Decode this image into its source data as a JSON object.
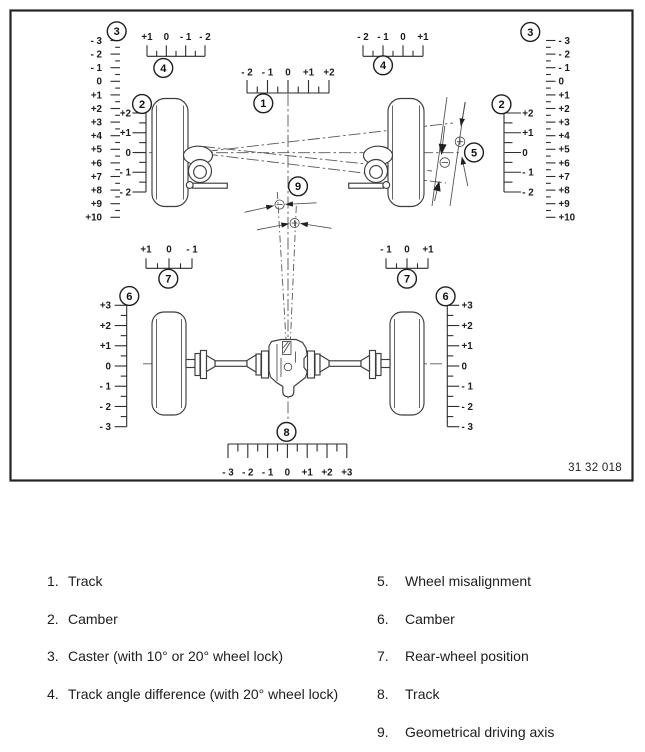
{
  "figure": {
    "drawing_number": "31 32 018"
  },
  "markers": {
    "track_front": "1",
    "camber_front": "2",
    "caster": "3",
    "track_angle": "4",
    "wheel_misalignment": "5",
    "camber_rear": "6",
    "rear_wheel_position": "7",
    "track_rear": "8",
    "geometrical_driving_axis": "9"
  },
  "scales": {
    "caster": [
      "- 3",
      "- 2",
      "- 1",
      "0",
      "+1",
      "+2",
      "+3",
      "+4",
      "+5",
      "+6",
      "+7",
      "+8",
      "+9",
      "+10"
    ],
    "track_angle_left": [
      "+1",
      "0",
      "- 1",
      "- 2"
    ],
    "track_angle_right": [
      "- 2",
      "- 1",
      "0",
      "+1"
    ],
    "track_front": [
      "- 2",
      "- 1",
      "0",
      "+1",
      "+2"
    ],
    "camber_front": [
      "+2",
      "+1",
      "0",
      "- 1",
      "- 2"
    ],
    "rear_pos_left": [
      "+1",
      "0",
      "- 1"
    ],
    "rear_pos_right": [
      "- 1",
      "0",
      "+1"
    ],
    "camber_rear": [
      "+3",
      "+2",
      "+1",
      "0",
      "- 1",
      "- 2",
      "- 3"
    ],
    "track_rear": [
      "- 3",
      "- 2",
      "- 1",
      "0",
      "+1",
      "+2",
      "+3"
    ]
  },
  "signs": {
    "plus": "+",
    "minus": "−"
  },
  "legend": {
    "left": [
      {
        "num": "1.",
        "key": "track-front",
        "label": "Track"
      },
      {
        "num": "2.",
        "key": "camber-front",
        "label": "Camber"
      },
      {
        "num": "3.",
        "key": "caster",
        "label": "Caster (with 10° or 20° wheel lock)"
      },
      {
        "num": "4.",
        "key": "track-angle-difference",
        "label": "Track angle difference (with 20° wheel lock)"
      }
    ],
    "right": [
      {
        "num": "5.",
        "key": "wheel-misalignment",
        "label": "Wheel misalignment"
      },
      {
        "num": "6.",
        "key": "camber-rear",
        "label": "Camber"
      },
      {
        "num": "7.",
        "key": "rear-wheel-position",
        "label": "Rear-wheel position"
      },
      {
        "num": "8.",
        "key": "track-rear",
        "label": "Track"
      },
      {
        "num": "9.",
        "key": "geometrical-driving-axis",
        "label": "Geometrical driving axis"
      }
    ]
  }
}
